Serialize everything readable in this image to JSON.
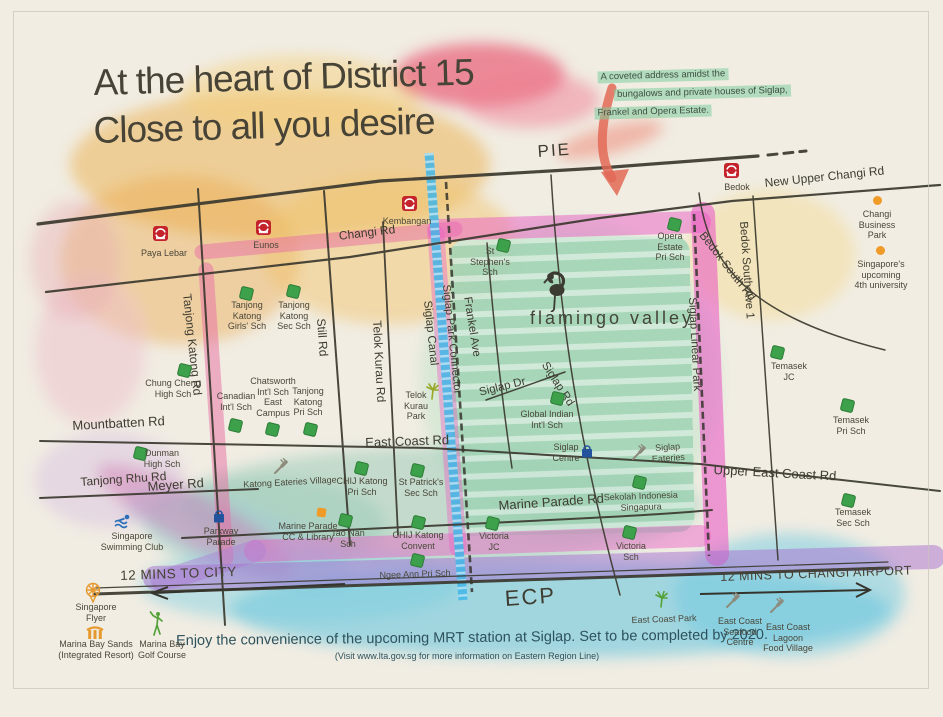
{
  "title": {
    "line1": "At the heart of District 15",
    "line2": "Close to all you desire"
  },
  "note": {
    "line1": "A coveted address amidst the",
    "line2": "bungalows and private houses of Siglap,",
    "line3": "Frankel and Opera Estate."
  },
  "logo": {
    "name": "flamingo valley"
  },
  "roads": {
    "pie": "PIE",
    "changi_rd": "Changi Rd",
    "new_upper_changi_rd": "New Upper Changi Rd",
    "tanjong_katong_rd": "Tanjong Katong Rd",
    "still_rd": "Still Rd",
    "telok_kurau_rd": "Telok Kurau Rd",
    "siglap_canal": "Siglap Canal",
    "siglap_park_connector": "Siglap Park Connector",
    "frankel_ave": "Frankel Ave",
    "siglap_rd": "Siglap Rd",
    "siglap_dr": "Siglap Dr",
    "bedok_south_rd": "Bedok South Rd",
    "bedok_south_ave1": "Bedok South Ave 1",
    "siglap_linear_park": "Siglap Linear Park",
    "mountbatten_rd": "Mountbatten Rd",
    "east_coast_rd": "East Coast Rd",
    "upper_east_coast_rd": "Upper East Coast Rd",
    "tanjong_rhu_rd": "Tanjong Rhu Rd",
    "meyer_rd": "Meyer Rd",
    "marine_parade_rd": "Marine Parade Rd",
    "ecp": "ECP"
  },
  "mrt": {
    "paya_lebar": "Paya Lebar",
    "eunos": "Eunos",
    "kembangan": "Kembangan",
    "bedok": "Bedok"
  },
  "schools": {
    "tk_girls": "Tanjong\nKatong\nGirls' Sch",
    "tk_sec": "Tanjong\nKatong\nSec Sch",
    "chung_cheng": "Chung Cheng\nHigh Sch",
    "canadian": "Canadian\nInt'l Sch",
    "chatsworth": "Chatsworth\nInt'l Sch\nEast\nCampus",
    "tk_pri": "Tanjong\nKatong\nPri Sch",
    "dunman": "Dunman\nHigh Sch",
    "st_stephens": "St\nStephen's\nSch",
    "opera_estate": "Opera\nEstate\nPri Sch",
    "global_indian": "Global Indian\nInt'l Sch",
    "sekolah_indonesia": "Sekolah Indonesia\nSingapura",
    "victoria_jc": "Victoria\nJC",
    "victoria_sch": "Victoria\nSch",
    "chij_pri": "CHIJ Katong\nPri Sch",
    "st_patricks": "St Patrick's\nSec Sch",
    "tao_nan": "Tao Nan\nSch",
    "chij_convent": "CHIJ Katong\nConvent",
    "ngee_ann": "Ngee Ann Pri Sch",
    "temasek_jc": "Temasek\nJC",
    "temasek_pri": "Temasek\nPri Sch",
    "temasek_sec": "Temasek\nSec Sch"
  },
  "landmarks": {
    "changi_business_park": "Changi\nBusiness\nPark",
    "fourth_university": "Singapore's\nupcoming\n4th university",
    "telok_kurau_park": "Telok\nKurau\nPark",
    "katong_eateries": "Katong Eateries Village",
    "siglap_centre": "Siglap\nCentre",
    "siglap_eateries": "Siglap\nEateries",
    "parkway_parade": "Parkway\nParade",
    "marine_parade_cc": "Marine Parade\nCC & Library",
    "swimming_club": "Singapore\nSwimming Club",
    "singapore_flyer": "Singapore\nFlyer",
    "marina_bay_sands": "Marina Bay Sands\n(Integrated Resort)",
    "marina_bay_golf": "Marina Bay\nGolf Course",
    "east_coast_park": "East Coast Park",
    "seafood_centre": "East Coast\nSeafood\nCentre",
    "lagoon_food_village": "East Coast\nLagoon\nFood Village"
  },
  "directions": {
    "city": "12 MINS TO CITY",
    "airport": "12 MINS TO CHANGI AIRPORT"
  },
  "footer": {
    "line1": "Enjoy the convenience of the upcoming MRT station at Siglap. Set to be completed by 2020.",
    "line2": "(Visit www.lta.gov.sg for more information on Eastern Region Line)"
  },
  "colors": {
    "mrt_red": "#c4232b",
    "school_green": "#3da04a",
    "landmark_orange": "#f09a28",
    "canal_blue": "#41b6e8",
    "highlight_magenta": "#ea5ec6",
    "highlight_purple": "#a770cf",
    "valley_green": "#9fd2b4",
    "note_highlight": "#7dcd9e"
  }
}
